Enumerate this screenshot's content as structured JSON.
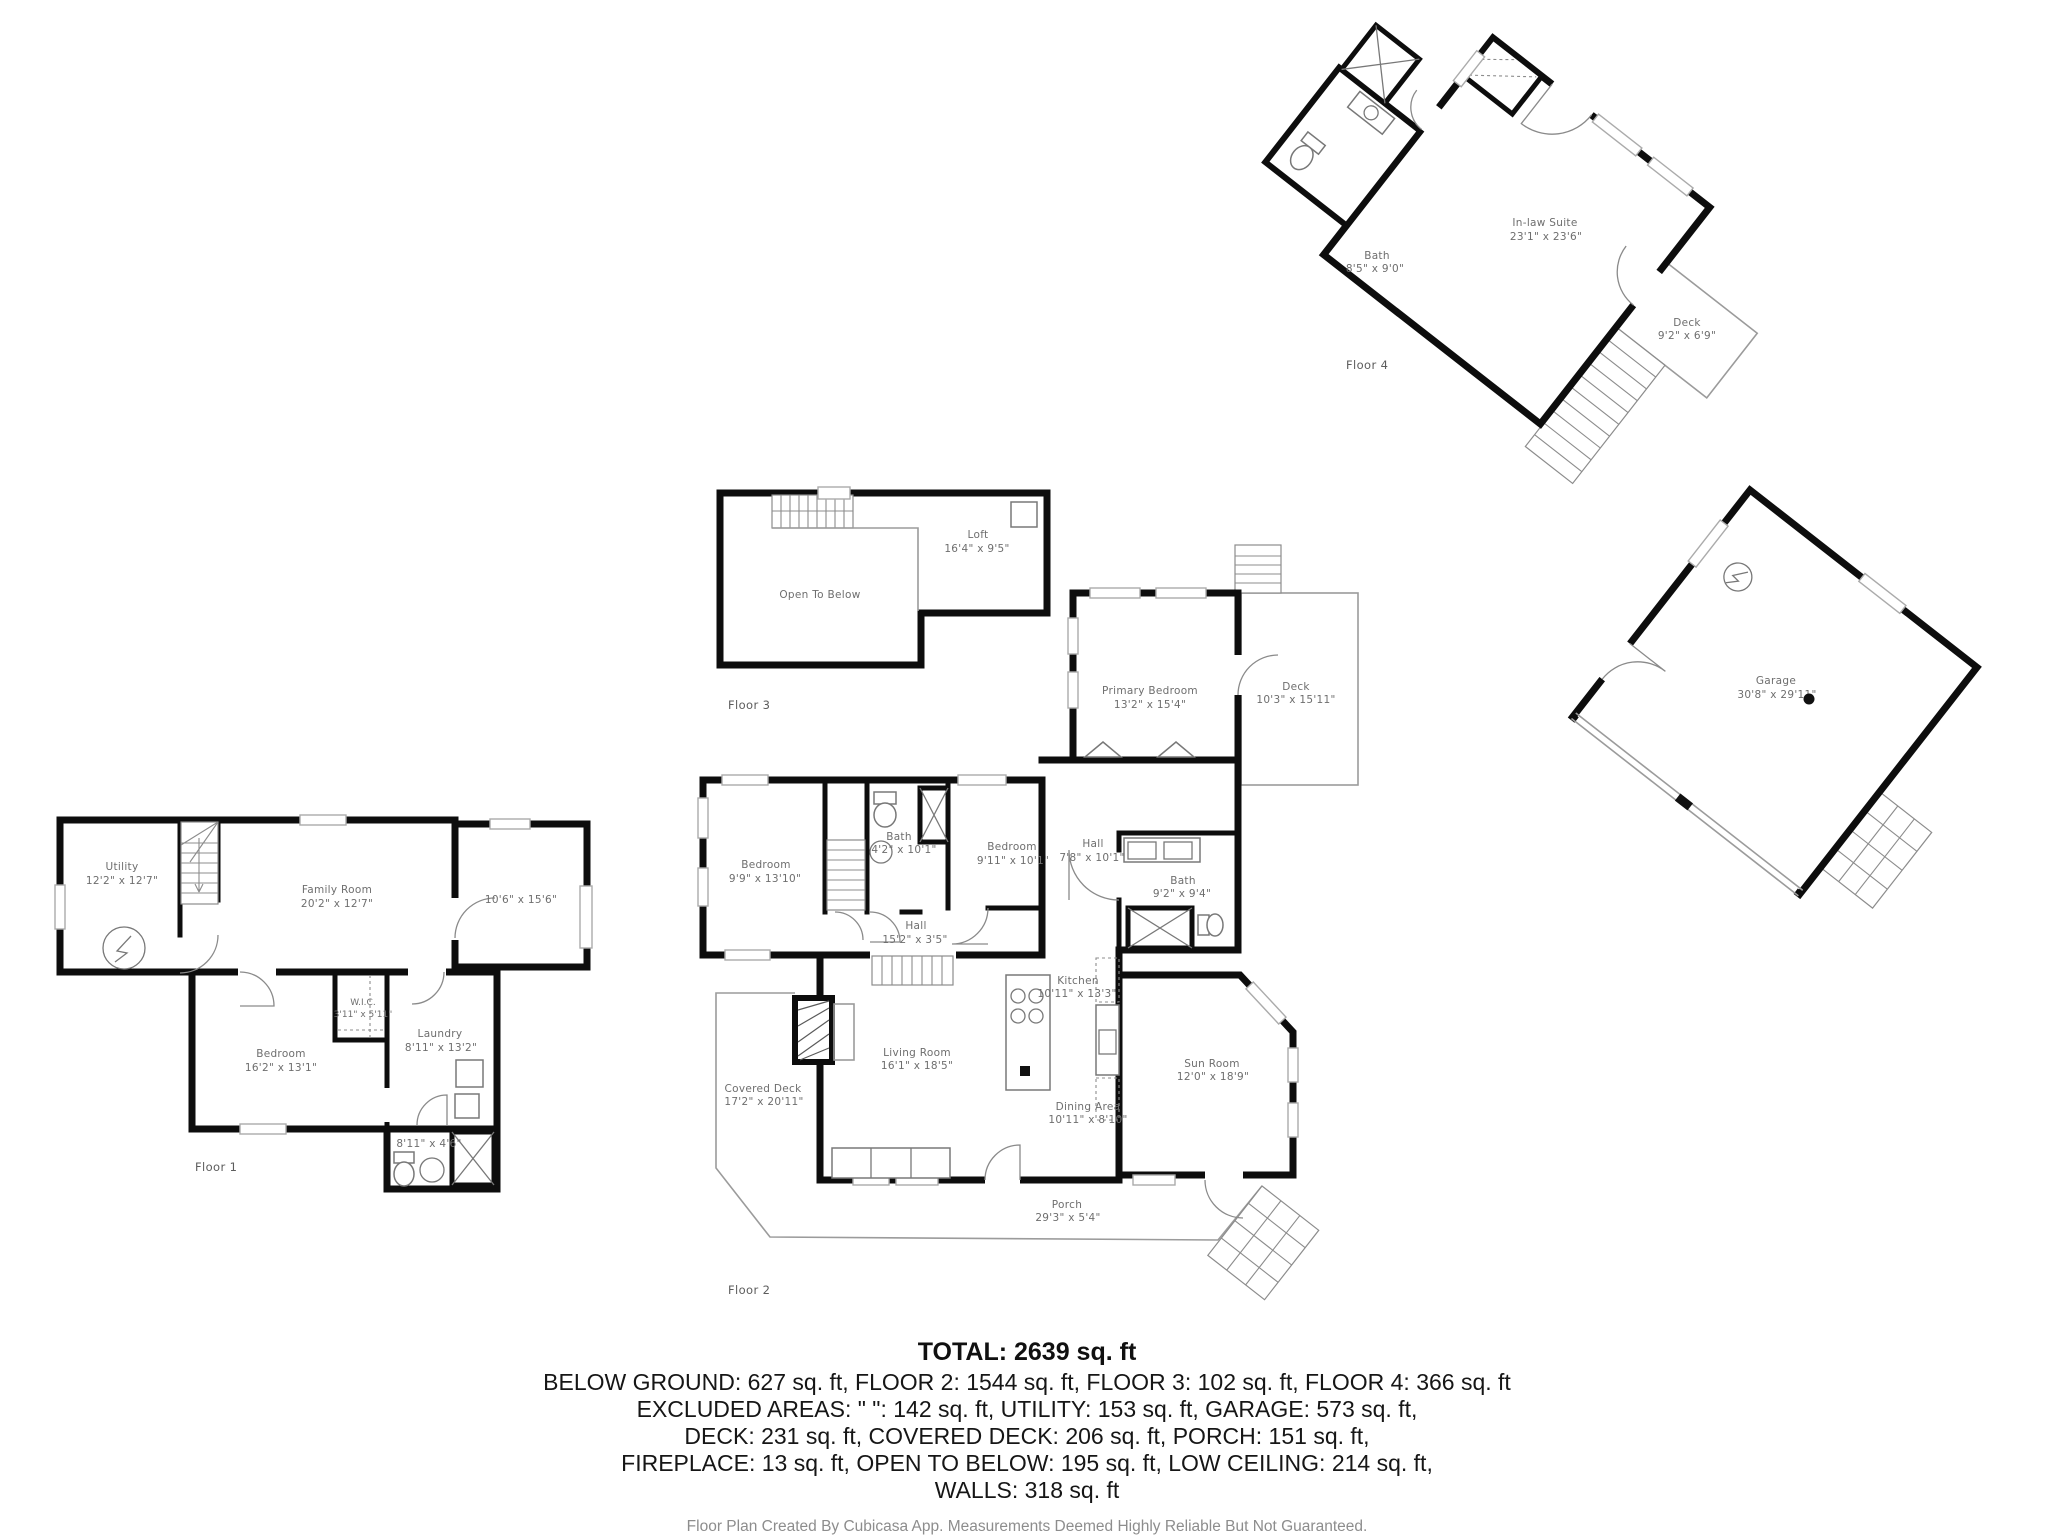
{
  "document": {
    "kind": "floor-plan",
    "wall_color": "#0d0d0d",
    "label_color": "#6e6e6e",
    "background": "#ffffff"
  },
  "floor1": {
    "label": "Floor 1",
    "utility": {
      "name": "Utility",
      "dims": "12'2\" x 12'7\""
    },
    "family_room": {
      "name": "Family Room",
      "dims": "20'2\" x 12'7\""
    },
    "room_unnamed": {
      "dims": "10'6\" x 15'6\""
    },
    "bedroom": {
      "name": "Bedroom",
      "dims": "16'2\" x 13'1\""
    },
    "wic": {
      "name": "W.I.C.",
      "dims": "3'11\" x 5'11\""
    },
    "laundry": {
      "name": "Laundry",
      "dims": "8'11\" x 13'2\""
    },
    "bath": {
      "dims": "8'11\" x 4'6\""
    }
  },
  "floor2": {
    "label": "Floor 2",
    "primary_bedroom": {
      "name": "Primary Bedroom",
      "dims": "13'2\" x 15'4\""
    },
    "deck": {
      "name": "Deck",
      "dims": "10'3\" x 15'11\""
    },
    "bedroom_left": {
      "name": "Bedroom",
      "dims": "9'9\" x 13'10\""
    },
    "bath_small": {
      "name": "Bath",
      "dims": "4'2\" x 10'1\""
    },
    "bedroom_mid": {
      "name": "Bedroom",
      "dims": "9'11\" x 10'1\""
    },
    "hall_upper": {
      "name": "Hall",
      "dims": "7'8\" x 10'1\""
    },
    "bath_right": {
      "name": "Bath",
      "dims": "9'2\" x 9'4\""
    },
    "hall_lower": {
      "name": "Hall",
      "dims": "15'2\" x 3'5\""
    },
    "kitchen": {
      "name": "Kitchen",
      "dims": "10'11\" x 13'3\""
    },
    "living_room": {
      "name": "Living Room",
      "dims": "16'1\" x 18'5\""
    },
    "dining_area": {
      "name": "Dining Area",
      "dims": "10'11\" x 8'10\""
    },
    "sun_room": {
      "name": "Sun Room",
      "dims": "12'0\" x 18'9\""
    },
    "covered_deck": {
      "name": "Covered Deck",
      "dims": "17'2\" x 20'11\""
    },
    "porch": {
      "name": "Porch",
      "dims": "29'3\" x 5'4\""
    }
  },
  "floor3": {
    "label": "Floor 3",
    "loft": {
      "name": "Loft",
      "dims": "16'4\" x 9'5\""
    },
    "open_to_below": {
      "name": "Open To Below"
    }
  },
  "floor4": {
    "label": "Floor 4",
    "inlaw_suite": {
      "name": "In-law Suite",
      "dims": "23'1\" x 23'6\""
    },
    "bath": {
      "name": "Bath",
      "dims": "8'5\" x 9'0\""
    },
    "deck": {
      "name": "Deck",
      "dims": "9'2\" x 6'9\""
    }
  },
  "garage": {
    "name": "Garage",
    "dims": "30'8\" x 29'11\""
  },
  "summary": {
    "total": "TOTAL: 2639 sq. ft",
    "lines": [
      "BELOW GROUND: 627 sq. ft, FLOOR 2: 1544 sq. ft, FLOOR 3: 102 sq. ft, FLOOR 4: 366 sq. ft",
      "EXCLUDED AREAS: \" \": 142 sq. ft, UTILITY: 153 sq. ft, GARAGE: 573 sq. ft,",
      "DECK: 231 sq. ft, COVERED DECK: 206 sq. ft, PORCH: 151 sq. ft,",
      "FIREPLACE: 13 sq. ft, OPEN TO BELOW: 195 sq. ft, LOW CEILING: 214 sq. ft,",
      "WALLS: 318 sq. ft"
    ]
  },
  "footer": {
    "credit": "Floor Plan Created By Cubicasa App. Measurements Deemed Highly Reliable But Not Guaranteed."
  }
}
